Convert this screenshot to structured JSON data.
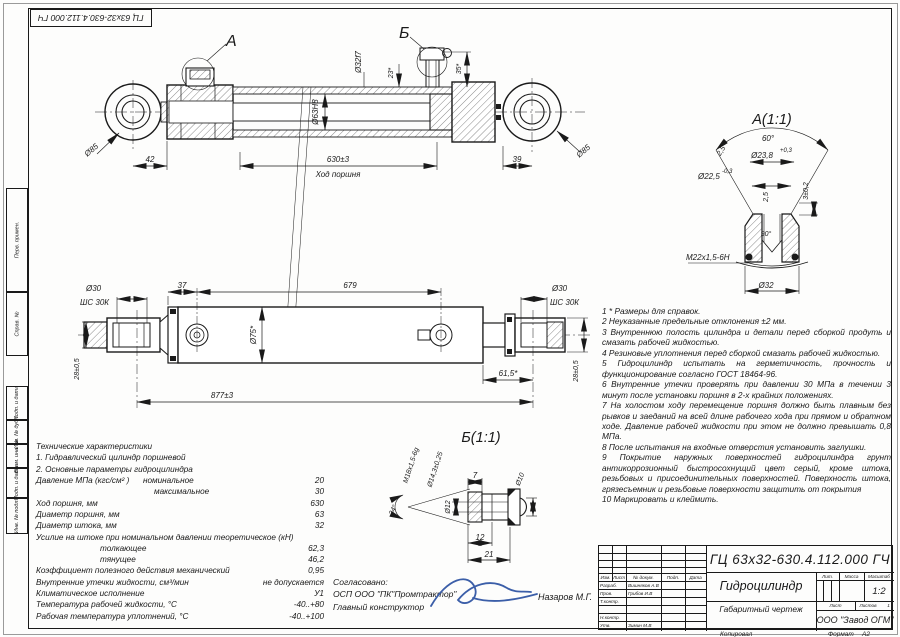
{
  "colors": {
    "line": "#1a1a1a",
    "background": "#ffffff",
    "signature": "#3b5ea8"
  },
  "frame": {
    "top_stamp": "ГЦ 63х32-630.4.112.000 ГЧ",
    "left_fields": [
      "Перв. примен.",
      "Справ. №",
      "Подп. и дата",
      "Инв. № дубл.",
      "Взам. инв. №",
      "Подп. и дата",
      "Инв. № подл."
    ],
    "kopiroval": "Копировал",
    "format_label": "Формат",
    "format_value": "А2"
  },
  "drawing": {
    "top_view": {
      "callout_a": "А",
      "callout_b": "Б",
      "dia85_left": "Ø85",
      "dia85_right": "Ø85",
      "dim42": "42",
      "dim630": "630±3",
      "stroke_label": "Ход поршня",
      "dim39": "39",
      "dia63": "Ø63Н8",
      "dia32f7": "Ø32f7",
      "dim23": "23*",
      "dim35": "35*"
    },
    "middle_view": {
      "dia30_left": "Ø30",
      "shs_left": "ШС 30К",
      "dia30_right": "Ø30",
      "shs_right": "ШС 30К",
      "dim37": "37",
      "dim679": "679",
      "dia75": "Ø75*",
      "dim28_left": "28±0,5",
      "dim28_right": "28±0,5",
      "dim877": "877±3",
      "dim615": "61,5*"
    },
    "detail_a": {
      "title": "А(1:1)",
      "angle60": "60°",
      "chamfer25": "2,5",
      "dia238": "Ø23,8",
      "dia238_tol": "+0,3",
      "dia225": "Ø22,5",
      "dia225_tol": "-0,3",
      "depth25": "2,5",
      "dim3": "3±0,2",
      "angle90": "90°",
      "thread": "М22х1,5-6Н",
      "dia32": "Ø32"
    },
    "detail_b": {
      "title": "Б(1:1)",
      "thread": "М18х1,5-6g",
      "dia143": "Ø14,3±0,25",
      "angle24": "24°",
      "dia12": "Ø12",
      "dim7": "7",
      "dia10": "Ø10",
      "dim12": "12",
      "dim21": "21"
    }
  },
  "notes": [
    "1 * Размеры для справок.",
    "2 Неуказанные предельные отклонения ±2 мм.",
    "3 Внутреннюю полость цилиндра и детали перед сборкой продуть и смазать рабочей жидкостью.",
    "4 Резиновые уплотнения перед сборкой смазать рабочей жидкостью.",
    "5 Гидроцилиндр испытать на герметичность, прочность и функционирование согласно ГОСТ 18464-96.",
    "6 Внутренние утечки проверять при давлении 30 МПа в течении 3 минут после установки поршня в 2-х крайних положениях.",
    "7 На холостом ходу перемещение поршня должно быть плавным без рывков и заеданий на всей длине рабочего хода при прямом и обратном ходе. Давление рабочей жидкости при этом не должно превышать 0,8 МПа.",
    "8 После испытания на входные отверстия установить заглушки.",
    "9 Покрытие наружных поверхностей гидроцилиндра грунт антикоррозионный быстросохнущий цвет серый, кроме штока, резьбовых и присоединительных поверхностей. Поверхность штока, грязесъемник и резьбовые поверхности защитить от покрытия",
    "10 Маркировать и клеймить."
  ],
  "specs": {
    "title": "Технические характеристики",
    "line1": "1. Гидравлический цилиндр поршневой",
    "line2": "2. Основные параметры гидроцилиндра",
    "rows": [
      {
        "label": "Давление МПа (кгс/см² )      номинальное",
        "value": "20"
      },
      {
        "label": "максимальное",
        "value": "30"
      },
      {
        "label": "Ход поршня, мм",
        "value": "630"
      },
      {
        "label": "Диаметр поршня, мм",
        "value": "63"
      },
      {
        "label": "Диаметр штока, мм",
        "value": "32"
      },
      {
        "label": "Усилие на штоке при номинальном давлении теоретическое (кН)",
        "value": ""
      },
      {
        "label": "толкающее",
        "value": "62,3"
      },
      {
        "label": "тянущее",
        "value": "46,2"
      },
      {
        "label": "Коэффициент полезного действия механический",
        "value": "0,95"
      },
      {
        "label": "Внутренние утечки жидкости, см³/мин",
        "value": "не допускается"
      },
      {
        "label": "Климатическое исполнение",
        "value": "У1"
      },
      {
        "label": "Температура рабочей жидкости, °С",
        "value": "-40..+80"
      },
      {
        "label": "Рабочая температура уплотнений, °С",
        "value": "-40..+100"
      }
    ]
  },
  "approval": {
    "line1": "Согласовано:",
    "line2": "ОСП ООО \"ПК\"Промтрактор\"",
    "line3": "Главный конструктор",
    "signer": "Назаров М.Г."
  },
  "title_block": {
    "doc_number": "ГЦ 63х32-630.4.112.000 ГЧ",
    "product_name": "Гидроцилиндр",
    "doc_type": "Габаритный чертеж",
    "company": "ООО \"Завод ОГМ\"",
    "header_cols": [
      "Изм.",
      "Лист",
      "№ докум.",
      "Подп.",
      "Дата"
    ],
    "roles": [
      {
        "role": "Разраб.",
        "name": "Вишняков А.В"
      },
      {
        "role": "Пров.",
        "name": "Грибов И.В"
      },
      {
        "role": "Т.контр.",
        "name": ""
      },
      {
        "role": "Н.контр.",
        "name": ""
      },
      {
        "role": "Утв.",
        "name": "Зимин М.В"
      }
    ],
    "lit_label": "Лит.",
    "mass_label": "Масса",
    "scale_label": "Масштаб",
    "scale_value": "1:2",
    "sheet_label": "Лист",
    "sheets_label": "Листов",
    "sheets_value": "1"
  }
}
